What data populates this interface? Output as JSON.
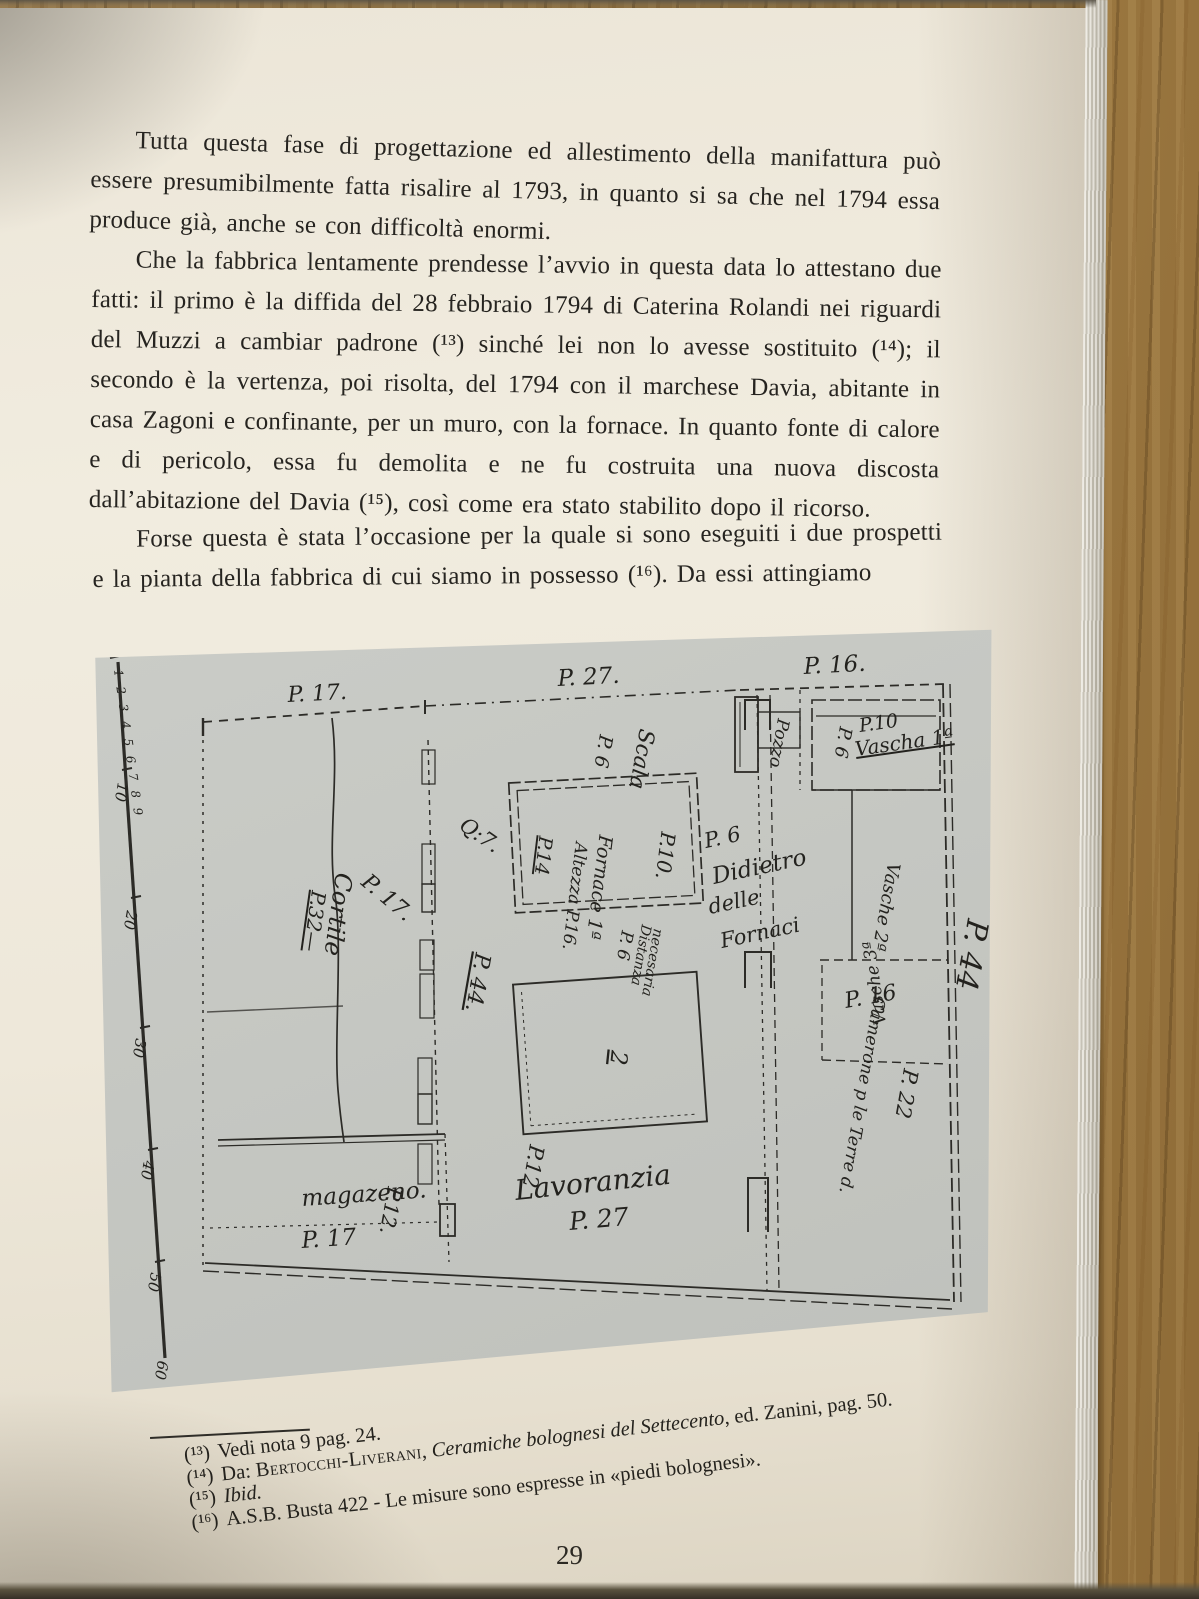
{
  "page_number": "29",
  "body": {
    "paragraphs": [
      "Tutta questa fase di progettazione ed allestimento della manifattura può essere presumibilmente fatta risalire al 1793, in quanto si sa che nel 1794 essa produce già, anche se con difficoltà enormi.",
      "Che la fabbrica lentamente prendesse l’avvio in questa data lo attestano due fatti: il primo è la diffida del 28 febbraio 1794 di Caterina Rolandi nei riguardi del Muzzi a cambiar padrone (¹³) sinché lei non lo avesse sostituito (¹⁴); il secondo è la vertenza, poi risolta, del 1794 con il marchese Davia, abitante in casa Zagoni e confinante, per un muro, con la fornace. In quanto fonte di calore e di pericolo, essa fu demolita e ne fu costruita una nuova discosta dall’abitazione del Davia (¹⁵), così come era stato stabilito dopo il ricorso.",
      "Forse questa è stata l’occasione per la quale si sono eseguiti i due prospetti e la pianta della fabbrica di cui siamo in possesso (¹⁶). Da essi attingiamo"
    ]
  },
  "plan": {
    "scale": {
      "small_digits": "1 2 3 4 5 6 7 8 9",
      "ticks": [
        "10",
        "20",
        "30",
        "40",
        "50",
        "60"
      ]
    },
    "labels": {
      "top_p17": "P. 17.",
      "top_p27": "P. 27.",
      "top_p16": "P. 16.",
      "pozzo": "Pozzo",
      "vascha1_p10": "P.10",
      "vascha1": "Vascha 1ª",
      "vascha1_p6": "P. 6",
      "scala": "Scala",
      "scala_p6": "P. 6",
      "fornace": "Fornace 1ª",
      "altezza": "Altezza P.16.",
      "fornace_p10": "P.10.",
      "fornace_p14": "P.14",
      "q7": "Q:7.",
      "wall_p44": "P. 44.",
      "cortile": "Cortile",
      "cortile_p32": "P.32—",
      "cortile_p17": "P. 17.",
      "didietro_p6": "P. 6",
      "didietro": "Didietro",
      "delle": "delle",
      "fornaci": "Fornaci",
      "distanza": "Distanza",
      "necesaria": "necesaria",
      "distanza_p6": "P. 6",
      "vasche2": "Vasche 2ª",
      "vasche3": "Vasche 3ª",
      "room2": "2",
      "p12": "P.12",
      "lavoranzia": "Lavoranzia",
      "bottom_p27": "P. 27",
      "magazeno": "magazeno.",
      "magazeno_p12": "P.12.",
      "magazeno_p17": "P. 17",
      "camerone_p16": "P. 16",
      "camerone": "Camerone p le Terre d.",
      "camerone_p22": "P. 22",
      "right_p44": "P. 44"
    }
  },
  "footnotes": {
    "items": [
      {
        "marker": "(¹³)",
        "text": "Vedi nota 9 pag. 24."
      },
      {
        "marker": "(¹⁴)",
        "pre": "Da: ",
        "author": "Bertocchi-Liverani",
        "sep": ", ",
        "title": "Ceramiche bolognesi del Settecento",
        "post": ", ed. Zanini, pag. 50."
      },
      {
        "marker": "(¹⁵)",
        "text_italic": "Ibid."
      },
      {
        "marker": "(¹⁶)",
        "text": "A.S.B. Busta 422 - Le misure sono espresse in «piedi bolognesi»."
      }
    ]
  }
}
